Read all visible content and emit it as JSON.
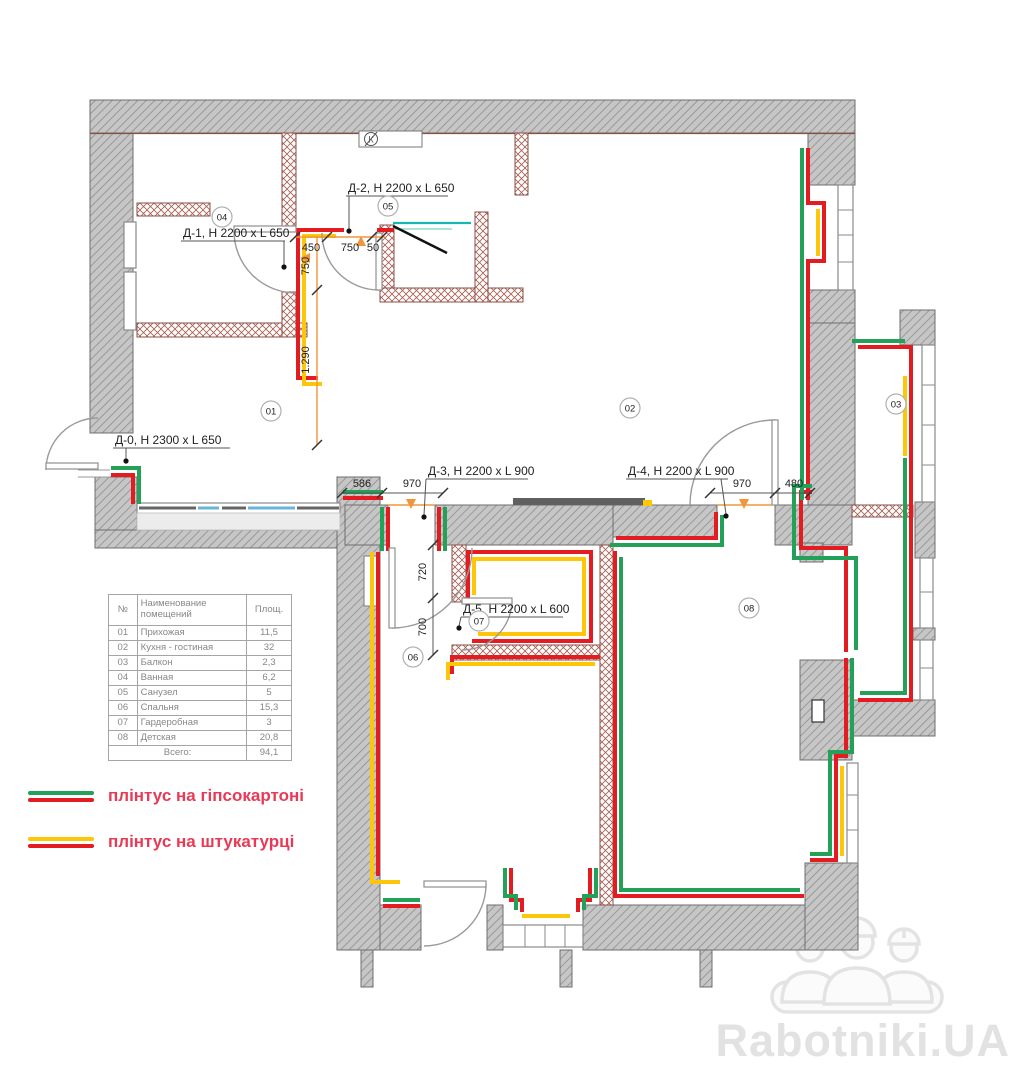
{
  "plan": {
    "door_labels": {
      "d0": "Д-0, Н 2300 x L 650",
      "d1": "Д-1, Н 2200 x L 650",
      "d2": "Д-2, Н 2200 x L 650",
      "d3": "Д-3, Н 2200 x L 900",
      "d4": "Д-4, Н 2200 x L 900",
      "d5": "Д-5, Н 2200 x L 600"
    },
    "dimensions": {
      "a450": "450",
      "a750": "750",
      "a50": "50",
      "v750": "750",
      "v1290": "1.290",
      "h586": "586",
      "h970a": "970",
      "h970b": "970",
      "h480": "480",
      "v720": "720",
      "v700": "700"
    },
    "room_markers": {
      "r01": "01",
      "r02": "02",
      "r03": "03",
      "r04": "04",
      "r05": "05",
      "r06": "06",
      "r07": "07",
      "r08": "08",
      "vent": "К"
    }
  },
  "table": {
    "headers": {
      "no": "№",
      "name": "Наименование помещений",
      "area": "Площ."
    },
    "rows": [
      {
        "no": "01",
        "name": "Прихожая",
        "area": "11,5"
      },
      {
        "no": "02",
        "name": "Кухня - гостиная",
        "area": "32"
      },
      {
        "no": "03",
        "name": "Балкон",
        "area": "2,3"
      },
      {
        "no": "04",
        "name": "Ванная",
        "area": "6,2"
      },
      {
        "no": "05",
        "name": "Санузел",
        "area": "5"
      },
      {
        "no": "06",
        "name": "Спальня",
        "area": "15,3"
      },
      {
        "no": "07",
        "name": "Гардеробная",
        "area": "3"
      },
      {
        "no": "08",
        "name": "Детская",
        "area": "20,8"
      }
    ],
    "total_label": "Всего:",
    "total_value": "94,1"
  },
  "legend": {
    "items": [
      {
        "label": "плінтус на гіпсокартоні",
        "top_color": "#23a159",
        "bottom_color": "#e21c21"
      },
      {
        "label": "плінтус на штукатурці",
        "top_color": "#fdc608",
        "bottom_color": "#e21c21"
      }
    ]
  },
  "watermark": {
    "text": "Rabotniki.UA"
  },
  "colors": {
    "skirting_red": "#e21c21",
    "skirting_green": "#23a159",
    "skirting_yellow": "#fdc608",
    "dimension_orange": "#f2953a",
    "legend_text": "#e83a56",
    "wall_gray": "#c6c6c6",
    "partition_brown": "#a85c50"
  }
}
